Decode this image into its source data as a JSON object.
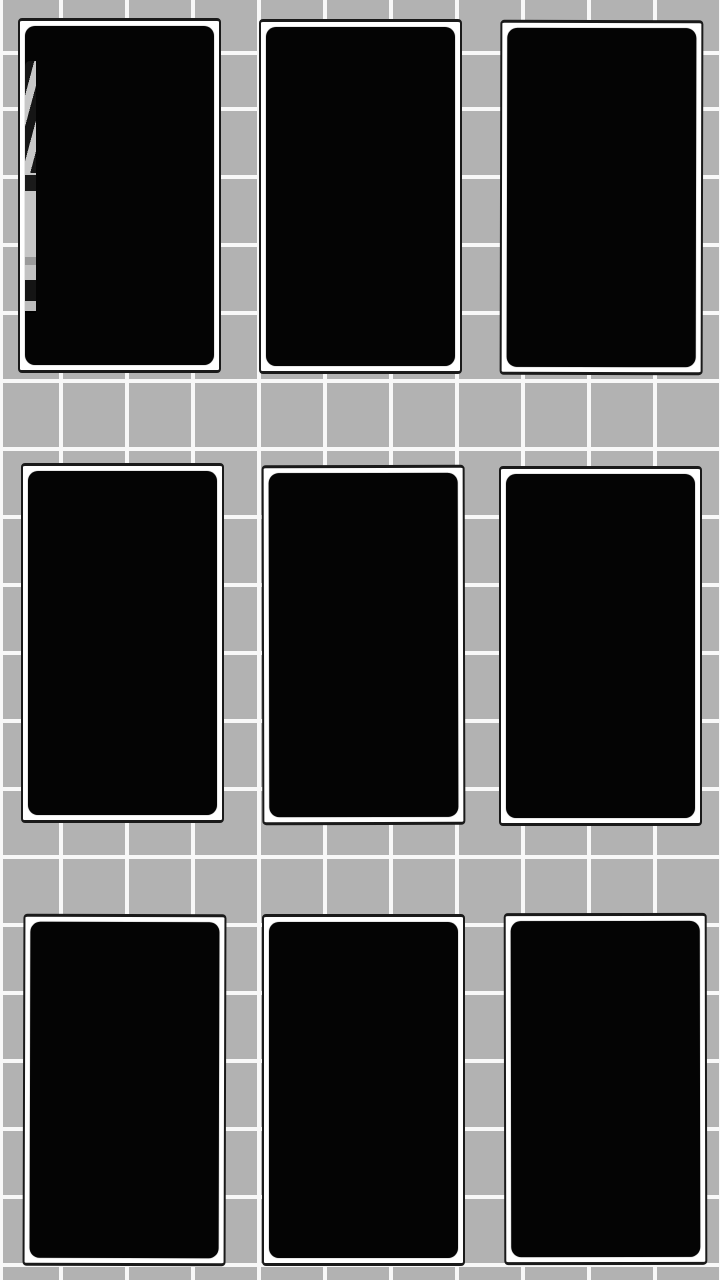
{
  "app": {
    "description": "3x3 grid of face-down black cards on a gray tiled wall"
  },
  "colors": {
    "background": "#b2b2b2",
    "grid_line": "#f8f8f8",
    "card_frame": "#ffffff",
    "card_outline": "#1a1a1a",
    "card_face": "#040404",
    "peek_light": "#c8c8c8",
    "peek_shadow": "#151515"
  },
  "wall_grid": {
    "tile_width": 66,
    "tile_height": 68,
    "line_thickness": 4
  },
  "board": {
    "rows": 3,
    "columns": 3,
    "card_count": 9
  },
  "cards": [
    {
      "id": "card-r1-c1",
      "row": 1,
      "col": 1,
      "state": "face-down",
      "peek": true,
      "peek_description": "narrow sliver of grayscale striped photo visible along left edge"
    },
    {
      "id": "card-r1-c2",
      "row": 1,
      "col": 2,
      "state": "face-down",
      "peek": false
    },
    {
      "id": "card-r1-c3",
      "row": 1,
      "col": 3,
      "state": "face-down",
      "peek": false
    },
    {
      "id": "card-r2-c1",
      "row": 2,
      "col": 1,
      "state": "face-down",
      "peek": false
    },
    {
      "id": "card-r2-c2",
      "row": 2,
      "col": 2,
      "state": "face-down",
      "peek": false
    },
    {
      "id": "card-r2-c3",
      "row": 2,
      "col": 3,
      "state": "face-down",
      "peek": false
    },
    {
      "id": "card-r3-c1",
      "row": 3,
      "col": 1,
      "state": "face-down",
      "peek": false
    },
    {
      "id": "card-r3-c2",
      "row": 3,
      "col": 2,
      "state": "face-down",
      "peek": false
    },
    {
      "id": "card-r3-c3",
      "row": 3,
      "col": 3,
      "state": "face-down",
      "peek": false
    }
  ]
}
